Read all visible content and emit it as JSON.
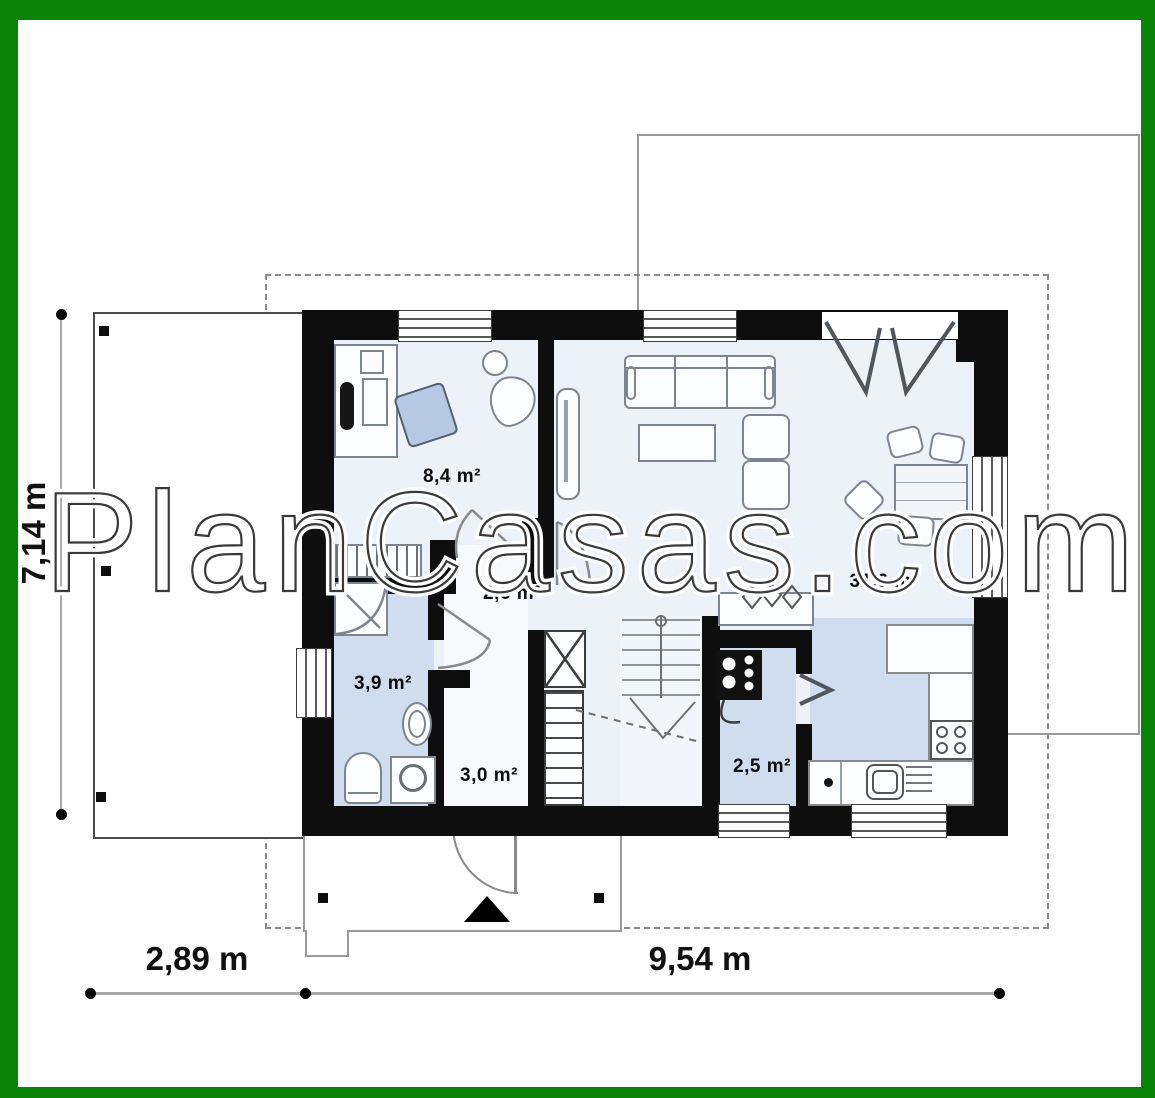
{
  "frame": {
    "border_color": "#0a8408"
  },
  "watermark": {
    "text": "PlanCasas.com"
  },
  "dimensions": {
    "side": "7,14 m",
    "bottom_left": "2,89 m",
    "bottom_right": "9,54 m"
  },
  "rooms": {
    "office": {
      "area": "8,4 m²"
    },
    "hall": {
      "area": "2,6 m²"
    },
    "bathroom": {
      "area": "3,9 m²"
    },
    "corridor": {
      "area": "3,0 m²"
    },
    "boiler": {
      "area": "2,5 m²"
    },
    "living": {
      "area": "31,6 m²"
    }
  },
  "colors": {
    "wall": "#0e0e0e",
    "wet_room_floor": "#cfddee",
    "base_floor": "#edf1f8",
    "furniture_outline": "#7d8590"
  }
}
